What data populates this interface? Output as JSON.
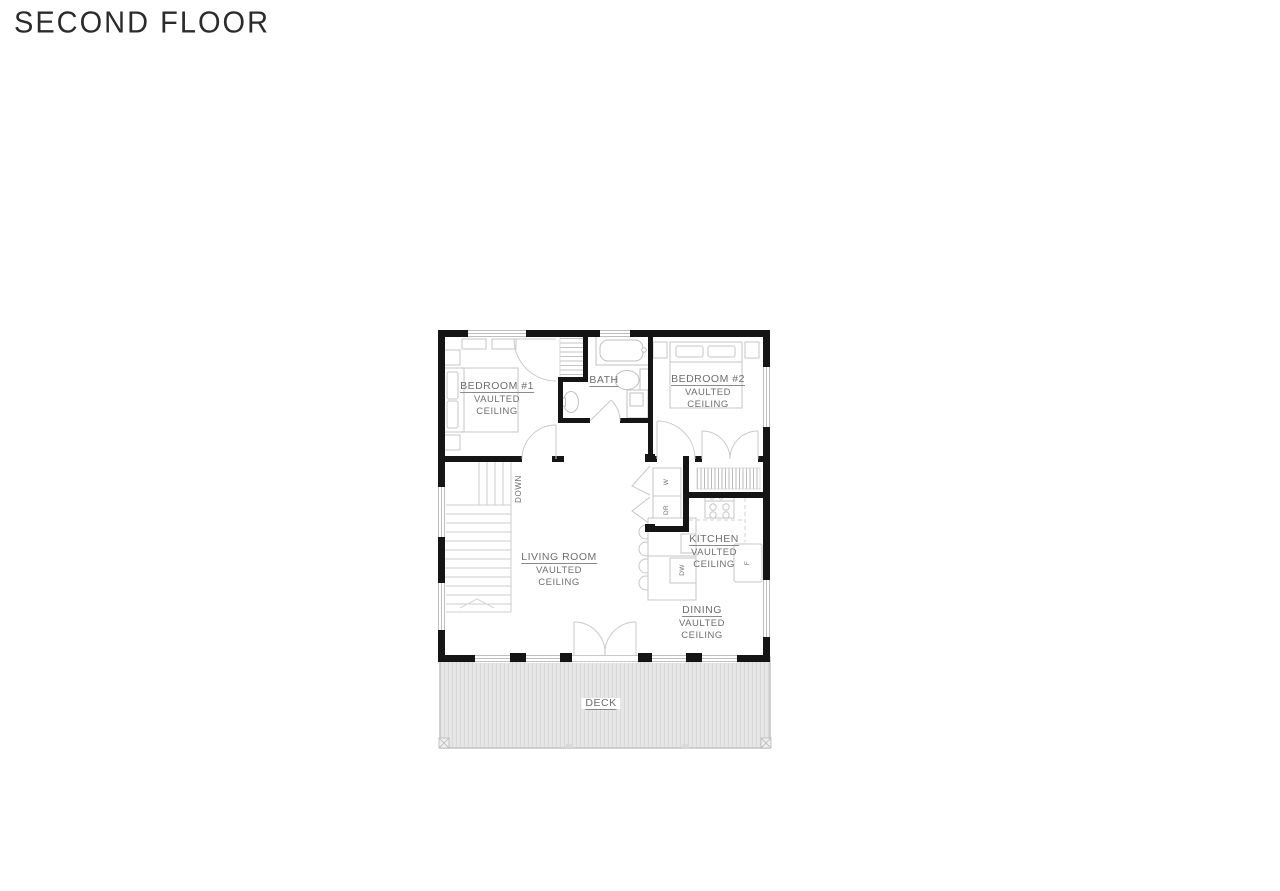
{
  "title": "SECOND FLOOR",
  "plan": {
    "rooms": {
      "bedroom1": {
        "name": "BEDROOM #1",
        "ceiling1": "VAULTED",
        "ceiling2": "CEILING"
      },
      "bath": {
        "name": "BATH"
      },
      "bedroom2": {
        "name": "BEDROOM #2",
        "ceiling1": "VAULTED",
        "ceiling2": "CEILING"
      },
      "living_room": {
        "name": "LIVING ROOM",
        "ceiling1": "VAULTED",
        "ceiling2": "CEILING"
      },
      "kitchen": {
        "name": "KITCHEN",
        "ceiling1": "VAULTED",
        "ceiling2": "CEILING"
      },
      "dining": {
        "name": "DINING",
        "ceiling1": "VAULTED",
        "ceiling2": "CEILING"
      },
      "deck": {
        "name": "DECK"
      }
    },
    "annotations": {
      "stairs_direction": "DOWN",
      "washer": "W",
      "dryer": "DR",
      "dishwasher": "DW",
      "refrigerator": "F"
    },
    "colors": {
      "wall": "#151515",
      "fixture_line": "#c6c6c6",
      "label_text": "#6e6e6e",
      "deck_fill": "#e6e6e6",
      "deck_stripe": "#d9d9d9"
    }
  }
}
